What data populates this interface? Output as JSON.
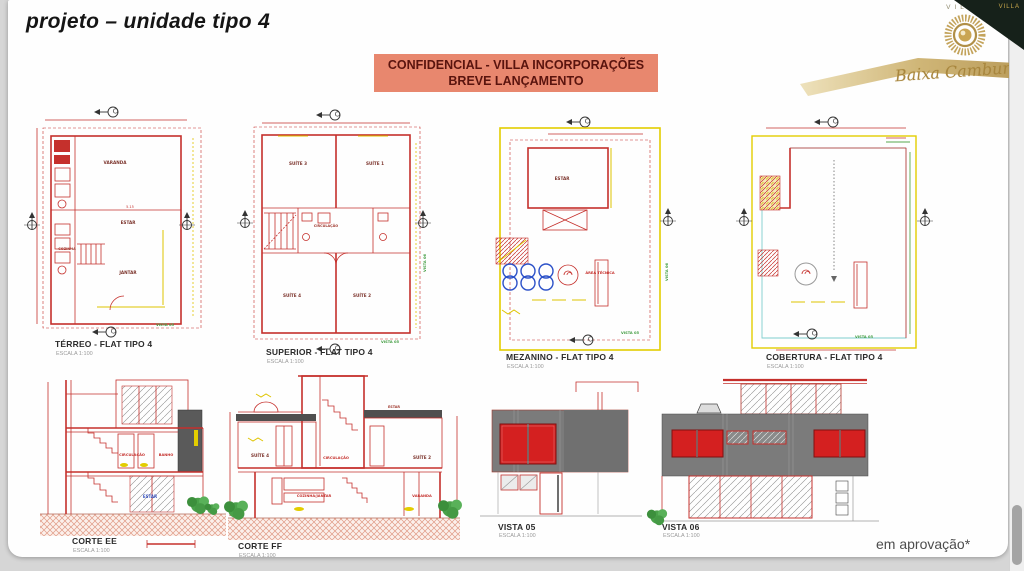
{
  "window": {
    "approval_note": "em aprovação*"
  },
  "header": {
    "title": "projeto – unidade tipo 4",
    "banner": {
      "line1": "CONFIDENCIAL - VILLA INCORPORAÇÕES",
      "line2": "BREVE LANÇAMENTO",
      "bg": "#e8876e",
      "fg": "#5a140e"
    },
    "logo": {
      "brand": "VILLA",
      "name": "Baixa Cambury",
      "corner": "VILLA",
      "gold": "#b9994f"
    }
  },
  "plans": [
    {
      "title": "TÉRREO - FLAT TIPO 4",
      "scale": "ESCALA 1:100",
      "dim": "5.15",
      "rooms": {
        "varanda": "VARANDA",
        "estar": "ESTAR",
        "cozinha": "COZINHA",
        "jantar": "JANTAR"
      }
    },
    {
      "title": "SUPERIOR - FLAT TIPO 4",
      "scale": "ESCALA 1:100",
      "rooms": {
        "suite3": "SUÍTE 3",
        "suite1": "SUÍTE 1",
        "circulacao": "CIRCULAÇÃO",
        "suite4": "SUÍTE 4",
        "suite2": "SUÍTE 2"
      }
    },
    {
      "title": "MEZANINO - FLAT TIPO 4",
      "scale": "ESCALA 1:100",
      "rooms": {
        "estar": "ESTAR",
        "area_tecnica": "ÁREA TÉCNICA"
      }
    },
    {
      "title": "COBERTURA - FLAT TIPO 4",
      "scale": "ESCALA 1:100"
    }
  ],
  "markers": {
    "vista05": "VISTA 05",
    "vista06": "VISTA 06"
  },
  "sections": [
    {
      "title": "CORTE EE",
      "scale": "ESCALA 1:100",
      "rooms": {
        "circulacao": "CIRCULAÇÃO",
        "banho": "BANHO",
        "estar": "ESTAR"
      }
    },
    {
      "title": "CORTE FF",
      "scale": "ESCALA 1:100",
      "rooms": {
        "suite4": "SUÍTE 4",
        "circulacao": "CIRCULAÇÃO",
        "estar": "ESTAR",
        "suite2": "SUÍTE 2",
        "cozinha_jantar": "COZINHA/JANTAR",
        "varanda": "VARANDA"
      }
    }
  ],
  "views": [
    {
      "title": "VISTA 05",
      "scale": "ESCALA 1:100"
    },
    {
      "title": "VISTA 06",
      "scale": "ESCALA 1:100"
    }
  ],
  "colors": {
    "line_red": "#c5302c",
    "dim_yellow": "#dfc400",
    "band_gray": "#7b7b7b",
    "window_red": "#d42020",
    "banner_bg": "#e8876e",
    "gold": "#b9994f"
  }
}
